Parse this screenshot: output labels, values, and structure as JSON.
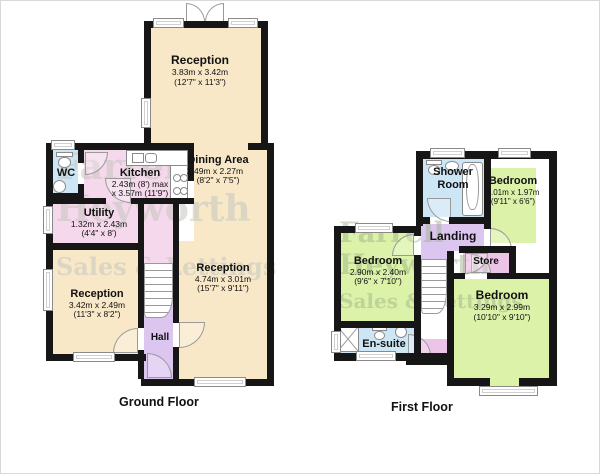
{
  "watermark": {
    "line1": "Farrell",
    "line2": "Heyworth",
    "line3": "Sales & Lettings"
  },
  "ground_floor": {
    "label": "Ground Floor",
    "rooms": {
      "reception_top": {
        "name": "Reception",
        "metric": "3.83m x 3.42m",
        "imperial": "(12'7\" x 11'3\")"
      },
      "wc": {
        "name": "WC"
      },
      "kitchen": {
        "name": "Kitchen",
        "metric": "2.43m (8') max",
        "imperial": "x 3.57m (11'9\")"
      },
      "dining": {
        "name": "Dining Area",
        "metric": "2.49m x 2.27m",
        "imperial": "(8'2\" x 7'5\")"
      },
      "utility": {
        "name": "Utility",
        "metric": "1.32m x 2.43m",
        "imperial": "(4'4\" x 8')"
      },
      "reception_left": {
        "name": "Reception",
        "metric": "3.42m x 2.49m",
        "imperial": "(11'3\" x 8'2\")"
      },
      "reception_main": {
        "name": "Reception",
        "metric": "4.74m x 3.01m",
        "imperial": "(15'7\" x 9'11\")"
      },
      "hall": {
        "name": "Hall"
      }
    }
  },
  "first_floor": {
    "label": "First Floor",
    "rooms": {
      "shower_room": {
        "name": "Shower Room"
      },
      "bedroom_top": {
        "name": "Bedroom",
        "metric": "3.01m x 1.97m",
        "imperial": "(9'11\" x 6'6\")"
      },
      "landing": {
        "name": "Landing"
      },
      "bedroom_left": {
        "name": "Bedroom",
        "metric": "2.90m x 2.40m",
        "imperial": "(9'6\" x 7'10\")"
      },
      "store": {
        "name": "Store"
      },
      "bedroom_main": {
        "name": "Bedroom",
        "metric": "3.29m x 2.99m",
        "imperial": "(10'10\" x 9'10\")"
      },
      "ensuite": {
        "name": "En-suite"
      }
    }
  },
  "colors": {
    "wall": "#161616",
    "room_cream": "#F8E8C8",
    "room_pink": "#F5D8EB",
    "room_lavender": "#DCC6F0",
    "room_pink2": "#ECC4E6",
    "room_blue": "#CDE6F5",
    "room_green": "#DCF2A9",
    "watermark_gray": "rgba(195,198,192,0.55)",
    "watermark_green": "rgba(150,175,130,0.45)"
  }
}
